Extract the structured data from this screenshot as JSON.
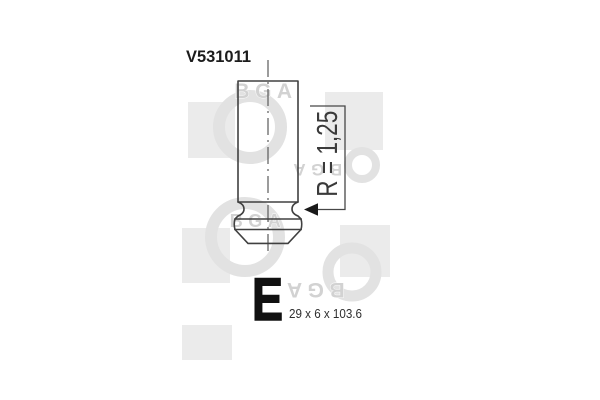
{
  "product": {
    "part_number": "V531011",
    "valve_letter": "E",
    "dimensions_label": "29 x 6 x 103.6",
    "radius_annotation": "R = 1,25"
  },
  "watermark": {
    "brand": "BGA"
  },
  "colors": {
    "background": "#ffffff",
    "drawing_line": "#404040",
    "label_text": "#1c1c1c",
    "valve_letter": "#111111",
    "watermark_square": "#ebebeb",
    "watermark_ring": "#e2e2e2",
    "watermark_text": "#d2d2d2"
  }
}
